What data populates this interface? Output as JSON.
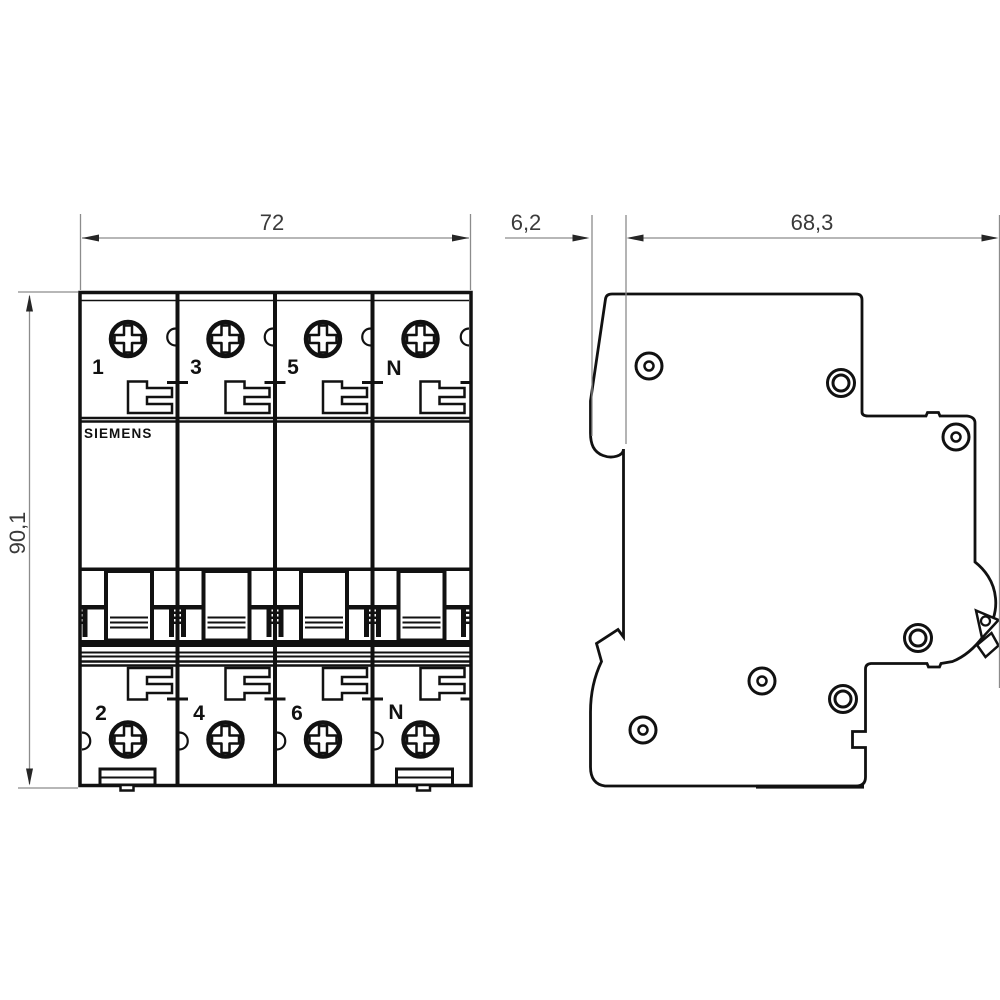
{
  "drawing": {
    "brand": "SIEMENS",
    "dims": {
      "front_width": "72",
      "side_offset": "6,2",
      "side_depth": "68,3",
      "front_height": "90,1"
    },
    "terminals": {
      "top": [
        "1",
        "3",
        "5",
        "N"
      ],
      "bottom": [
        "2",
        "4",
        "6",
        "N"
      ]
    },
    "colors": {
      "background": "#ffffff",
      "line": "#111111",
      "dim_line": "#8c8c8c",
      "arrow": "#262626",
      "dim_text": "#3a3a3a"
    }
  }
}
